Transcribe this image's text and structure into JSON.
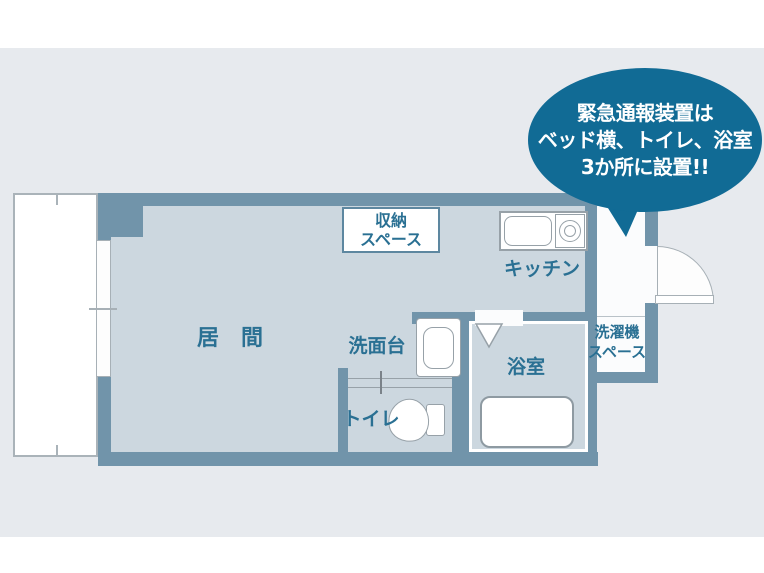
{
  "bubble": {
    "line1": "緊急通報装置は",
    "line2": "ベッド横、トイレ、浴室",
    "line3": "3か所に設置!!",
    "bg_color": "#116b95",
    "text_color": "#ffffff"
  },
  "rooms": {
    "living": {
      "label": "居　間"
    },
    "storage": {
      "label_line1": "収納",
      "label_line2": "スペース"
    },
    "kitchen": {
      "label": "キッチン"
    },
    "washstand": {
      "label": "洗面台"
    },
    "toilet": {
      "label": "トイレ"
    },
    "bathroom": {
      "label": "浴室"
    },
    "laundry": {
      "label_line1": "洗濯機",
      "label_line2": "スペース"
    }
  },
  "colors": {
    "wall": "#7194aa",
    "floor": "#ccd7df",
    "background": "#e7eaee",
    "label_text": "#2a7093",
    "bubble": "#116b95"
  }
}
